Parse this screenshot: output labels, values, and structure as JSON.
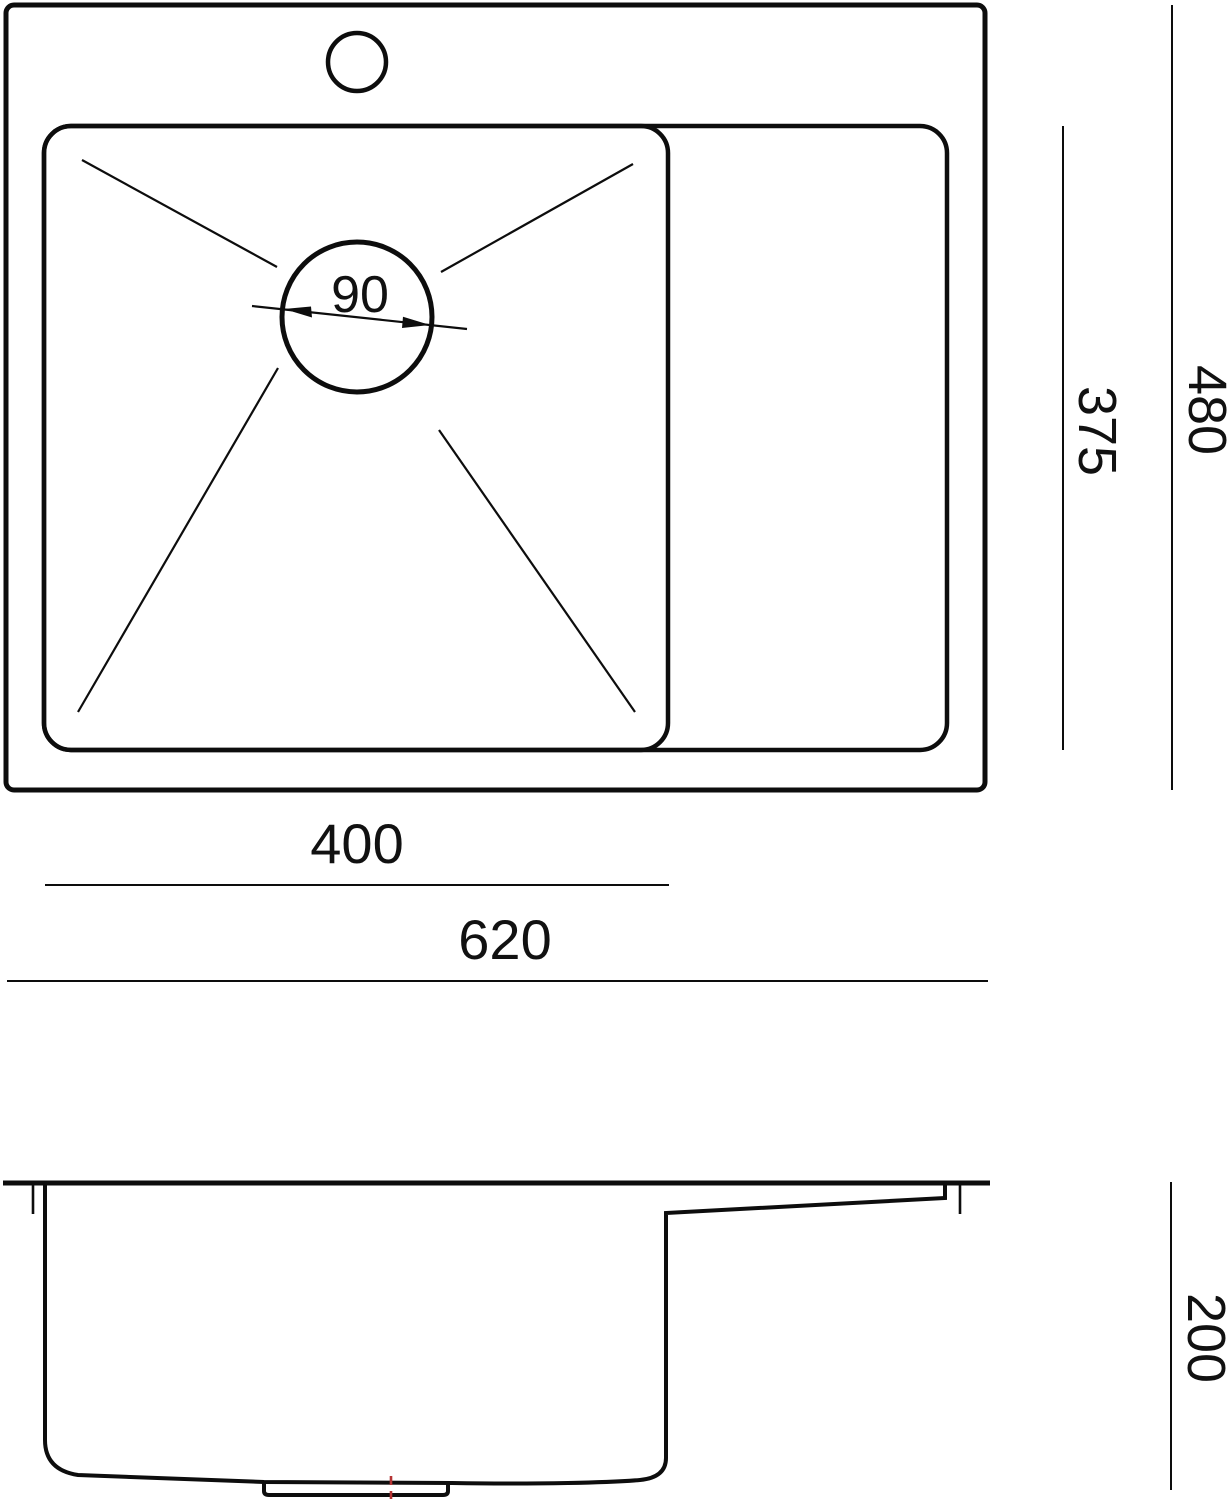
{
  "colors": {
    "line": "#0d0d0d",
    "background": "#ffffff",
    "drain_centerline_red": "#b53434"
  },
  "dimensions": {
    "drain_diameter": "90",
    "outer_depth": "480",
    "bowl_inner_depth": "375",
    "bowl_width": "400",
    "overall_width": "620",
    "bowl_height": "200"
  }
}
